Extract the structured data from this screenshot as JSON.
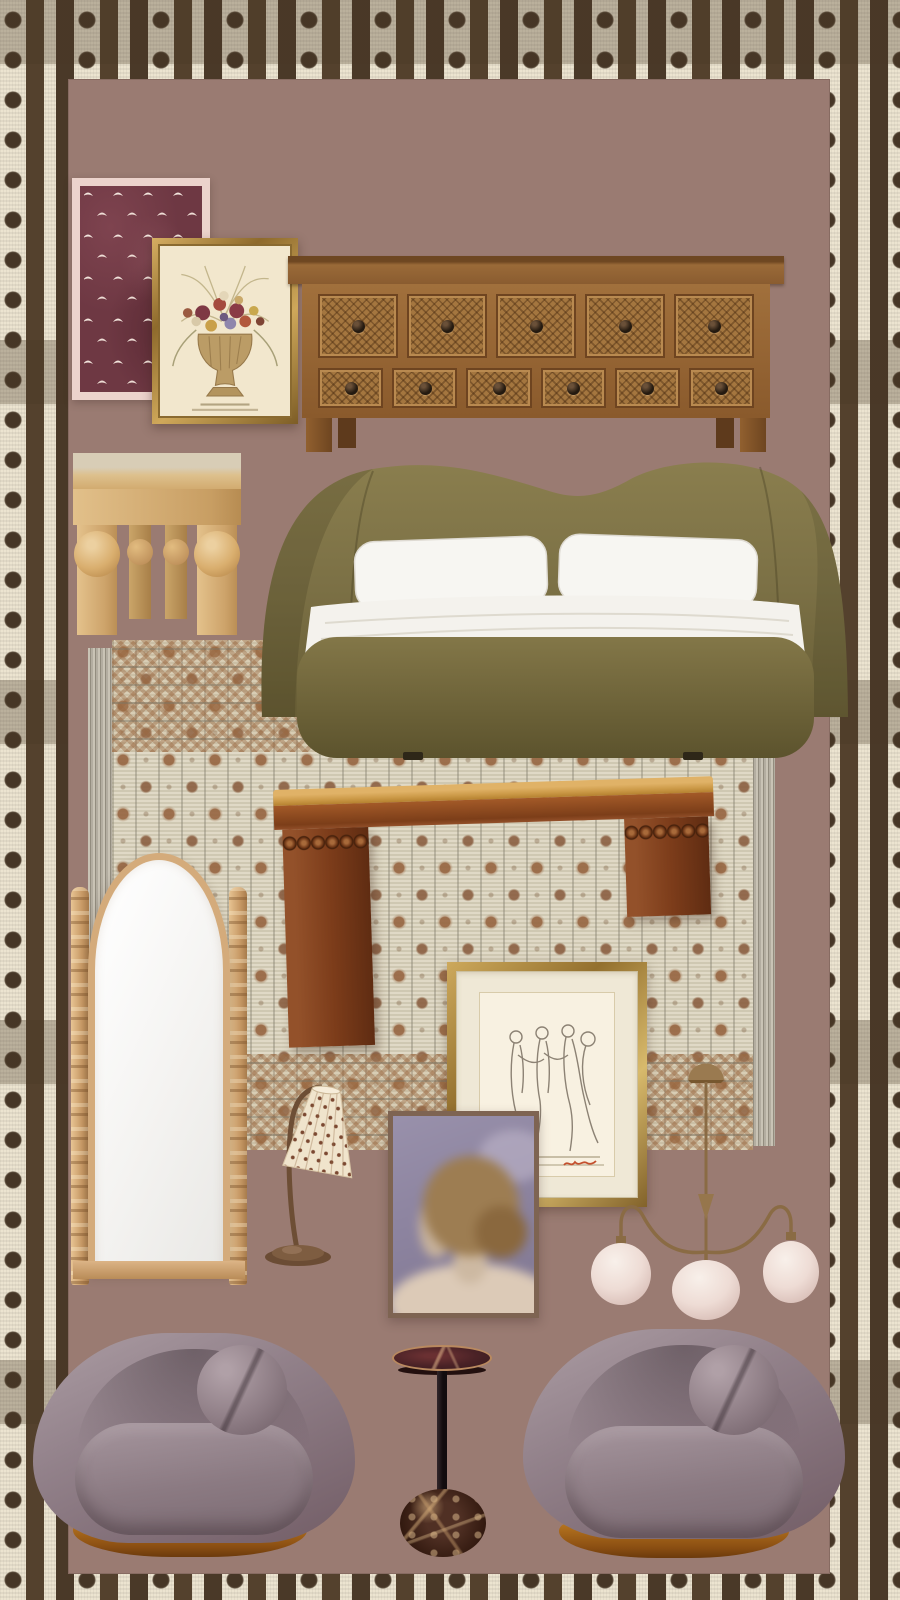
{
  "board": {
    "label": "Bedroom furniture and decor mood board",
    "background_note": "striped dotted textile border around mauve panel"
  },
  "colors": {
    "panel": "#9a7b72",
    "border-cream": "#ece4d0",
    "border-stripe": "#54412d",
    "border-dot": "#463626",
    "burgundy-art": "#6e3843",
    "art-mat-pink": "#ecd3cc",
    "frame-gold": "#c6a156",
    "console-wood": "#9a6a38",
    "oak": "#d9b57f",
    "bed-olive": "#7b7045",
    "bedding-white": "#f4f2ed",
    "rug-ground": "#dcd5bf",
    "rug-motif": "#96643f",
    "bench-wood": "#7c3e19",
    "bench-cushion": "#cc9a48",
    "mirror-wood": "#d4ab7b",
    "sketch-paper": "#f8f1e1",
    "portrait-mauve": "#8d84a0",
    "brass": "#8a6b44",
    "globe-blush": "#eedcd5",
    "velvet-gray": "#92818a",
    "marble-maroon": "#4a2226",
    "chair-base-wood": "#b5741f"
  },
  "items": {
    "border": {
      "label": "Brown and cream striped dotted textile border"
    },
    "panel": {
      "label": "Mauve backdrop panel"
    },
    "bird_print": {
      "label": "Burgundy art print with scattered white birds in pale pink mat"
    },
    "botanical_print": {
      "label": "Gold framed pressed-flower botanical print with urn bouquet"
    },
    "console": {
      "label": "Rustic carved wood console with eleven lattice drawers and ring pulls"
    },
    "side_table": {
      "label": "Light oak side table with sphere-detail legs"
    },
    "bed": {
      "label": "Olive green upholstered bed with curved wing headboard and white bedding"
    },
    "rug": {
      "label": "Vintage cream area rug with rust floral motifs and fringe"
    },
    "bench": {
      "label": "Walnut waterfall bench with caramel cushion and bobbin ball detail"
    },
    "mirror": {
      "label": "Arched full-length floor mirror with turned bobbin posts"
    },
    "sketch": {
      "label": "Gold bamboo framed figure sketch with red signature"
    },
    "lamp": {
      "label": "Bronze gooseneck table lamp with patterned pleated shade"
    },
    "portrait": {
      "label": "Soft-focus portrait painting of a woman from behind in thin wood frame"
    },
    "chandelier": {
      "label": "Brass three-arm chandelier with blush glass globes"
    },
    "chair_left": {
      "label": "Mauve gray velvet barrel swivel chair with ball pillow, left"
    },
    "chair_right": {
      "label": "Mauve gray velvet barrel swivel chair with ball pillow, right"
    },
    "martini_table": {
      "label": "Marble martini side table with black stem and breccia sphere base"
    }
  }
}
